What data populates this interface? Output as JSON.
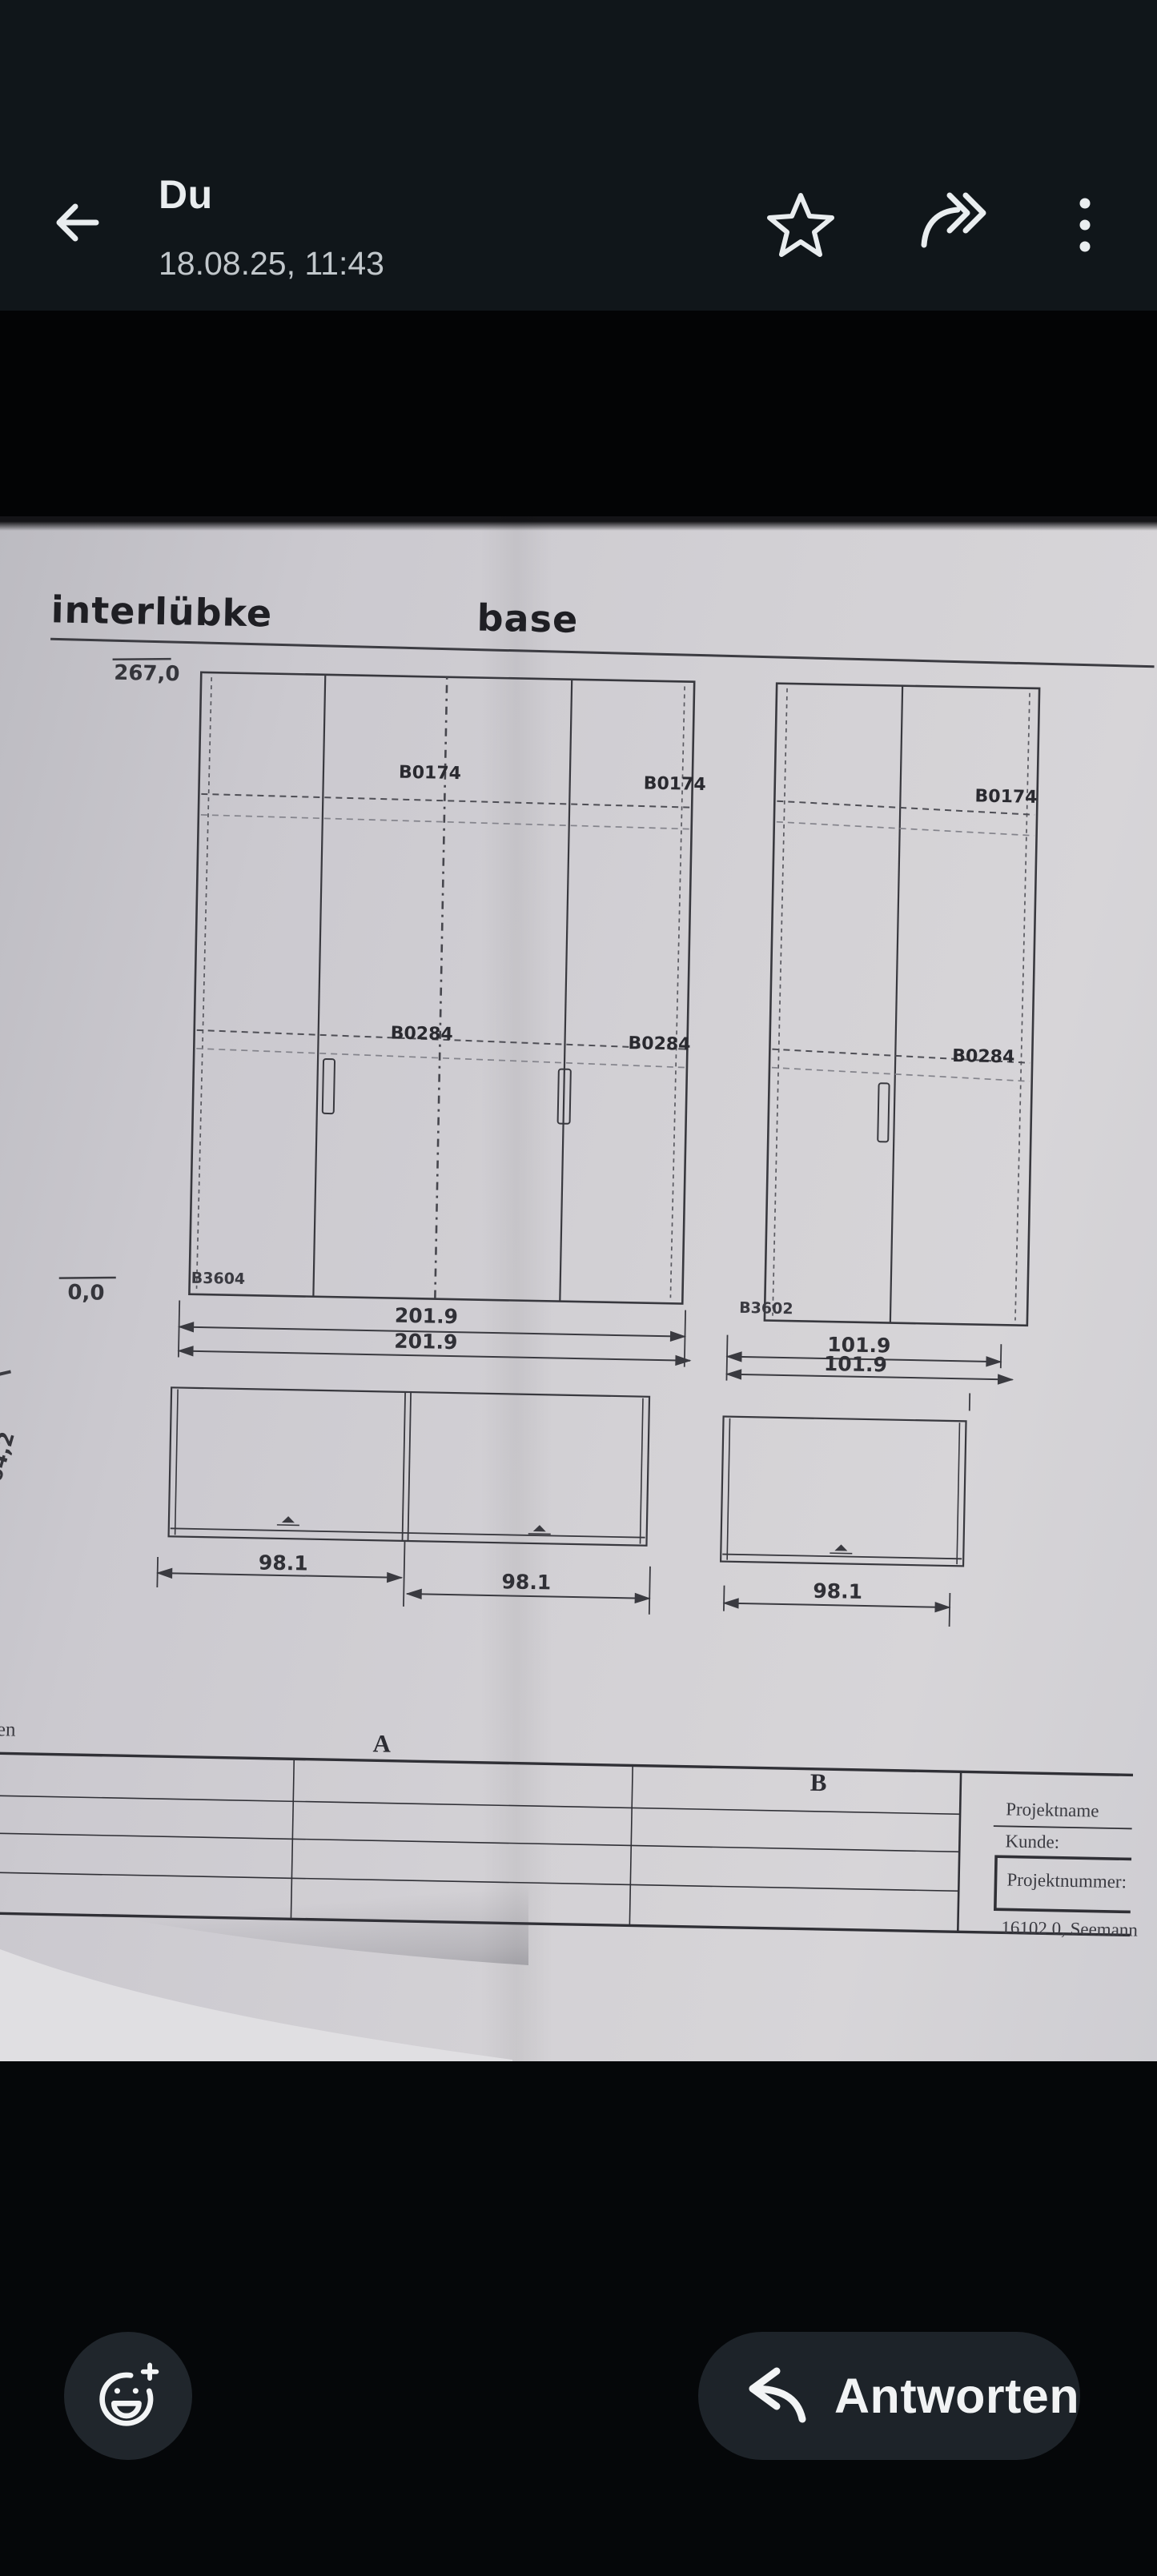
{
  "header": {
    "title": "Du",
    "subtitle": "18.08.25, 11:43",
    "icons": {
      "back": "back-arrow",
      "star": "star-outline",
      "forward": "forward-arrow",
      "menu": "more-vertical-dots"
    }
  },
  "viewer": {
    "brand": "interlübke",
    "product": "base",
    "dims": {
      "height_top": "267,0",
      "height_bottom": "0,0",
      "depth_side": "64,2",
      "width_left_1": "201.9",
      "width_left_2": "201.9",
      "width_right_1": "101.9",
      "width_right_2": "101.9",
      "plan_left_1": "98.1",
      "plan_left_2": "98.1",
      "plan_right_1": "98.1"
    },
    "labels": {
      "b0174_l1": "B0174",
      "b0174_l2": "B0174",
      "b0174_r": "B0174",
      "b0284_l1": "B0284",
      "b0284_l2": "B0284",
      "b0284_r": "B0284",
      "b3604": "B3604",
      "b3602": "B3602",
      "margin_cut": "eilen",
      "grid_a": "A",
      "grid_b": "B"
    },
    "titleblock": {
      "projektname": "Projektname",
      "kunde": "Kunde:",
      "projektnummer": "Projektnummer:",
      "project_id": "16102 0, Seemann"
    },
    "colors": {
      "paper": "#d3d1d5",
      "ink": "#38383e",
      "appbar": "#10161a",
      "pill": "#1d2329"
    }
  },
  "footer": {
    "reply_label": "Antworten",
    "emoji_icon": "add-reaction-smiley",
    "reply_icon": "reply-arrow"
  }
}
